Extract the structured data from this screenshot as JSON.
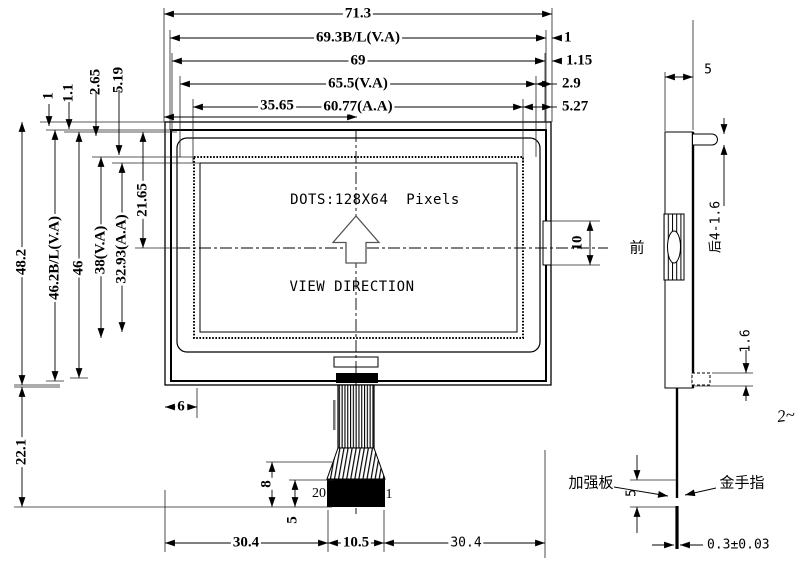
{
  "front_view": {
    "top_dims": {
      "total": "71.3",
      "backlight": "69.3B/L(V.A)",
      "glass": "69",
      "viewing_area": "65.5(V.A)",
      "active_area": "60.77(A.A)",
      "center": "35.65"
    },
    "right_offsets": {
      "backlight": "1",
      "glass": "1.15",
      "viewing_area": "2.9",
      "active_area": "5.27"
    },
    "left_dims": {
      "total": "48.2",
      "backlight": "46.2B/L(V.A)",
      "glass": "46",
      "viewing_area": "38(V.A)",
      "active_area": "32.93(A.A)",
      "center": "21.65",
      "fpc_length": "22.1"
    },
    "top_offsets": {
      "backlight": "1",
      "glass": "1.1",
      "bezel": "2.65",
      "viewing_area": "5.19"
    },
    "screen": {
      "dots": "DOTS:128X64  Pixels",
      "view_direction": "VIEW DIRECTION"
    },
    "notch_height": "10",
    "bottom": {
      "edge_offset": "6",
      "left": "30.4",
      "fpc_width": "10.5",
      "right": "30.4",
      "flare_height": "8",
      "stiffener_height": "5",
      "pin_20": "20",
      "pin_1": "1"
    }
  },
  "side_view": {
    "thickness": "5",
    "front": "前",
    "boss": "后4-1.6",
    "stiffener_thickness": "1.6",
    "gold_length": "5",
    "stiffener": "加强板",
    "gold_finger": "金手指",
    "fpc_thickness": "0.3±0.03",
    "note": "2~"
  }
}
